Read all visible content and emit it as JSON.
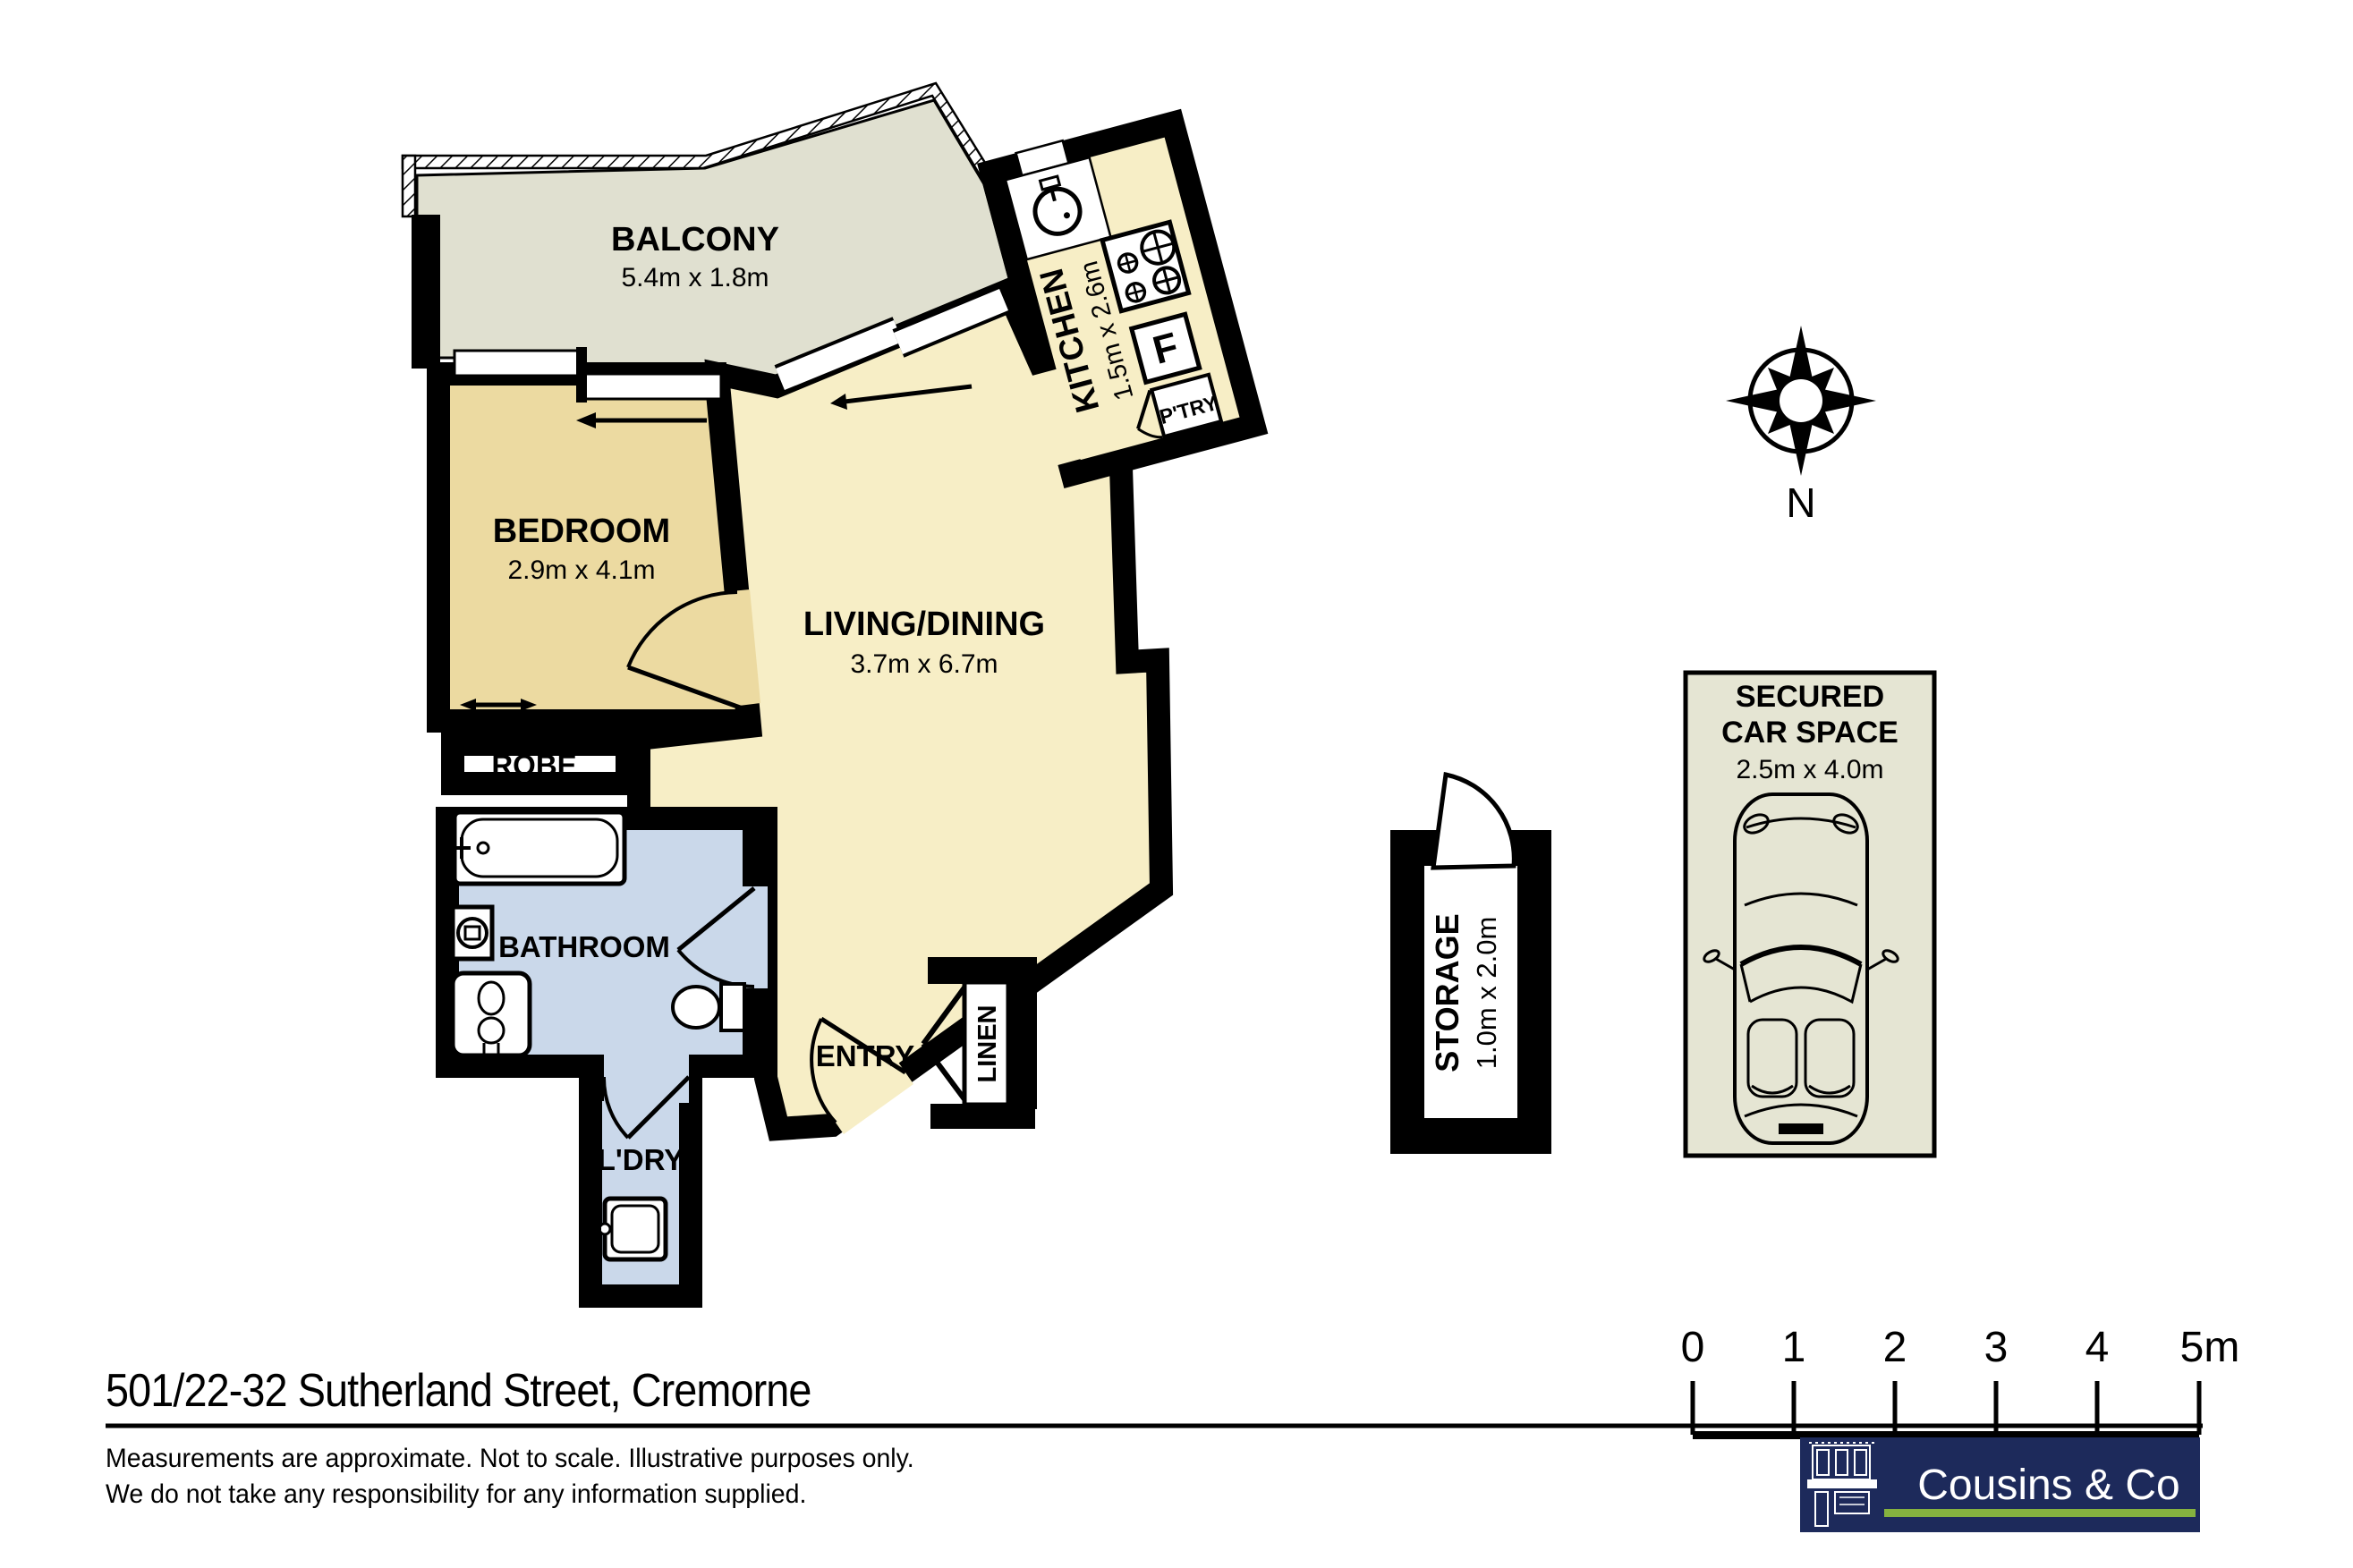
{
  "title": "501/22-32 Sutherland Street, Cremorne",
  "disclaimer": {
    "line1": "Measurements are approximate. Not to scale. Illustrative purposes only.",
    "line2": "We do not take any responsibility for any information supplied."
  },
  "compass": {
    "north_label": "N"
  },
  "scale_bar": {
    "ticks": [
      "0",
      "1",
      "2",
      "3",
      "4",
      "5m"
    ]
  },
  "brand": {
    "name": "Cousins & Co"
  },
  "rooms": {
    "balcony": {
      "name": "BALCONY",
      "dims": "5.4m x 1.8m"
    },
    "bedroom": {
      "name": "BEDROOM",
      "dims": "2.9m x 4.1m"
    },
    "living": {
      "name": "LIVING/DINING",
      "dims": "3.7m x 6.7m"
    },
    "kitchen": {
      "name": "KITCHEN",
      "dims": "1.5m x 2.6m"
    },
    "pantry": {
      "name": "P'TRY"
    },
    "fridge": {
      "label": "F"
    },
    "robe": {
      "name": "ROBE"
    },
    "bathroom": {
      "name": "BATHROOM"
    },
    "entry": {
      "name": "ENTRY"
    },
    "linen": {
      "name": "LINEN"
    },
    "laundry": {
      "name": "L'DRY"
    },
    "storage": {
      "name": "STORAGE",
      "dims": "1.0m x 2.0m"
    },
    "car_space": {
      "line1": "SECURED",
      "line2": "CAR SPACE",
      "dims": "2.5m x 4.0m"
    }
  },
  "colors": {
    "floor_main": "#f7eec6",
    "floor_bedroom": "#ecdaa1",
    "floor_wet": "#cad8ea",
    "floor_balcony": "#e0e0d0",
    "wall": "#000000",
    "brand_navy": "#1d2a5b",
    "brand_green": "#85b23f"
  }
}
